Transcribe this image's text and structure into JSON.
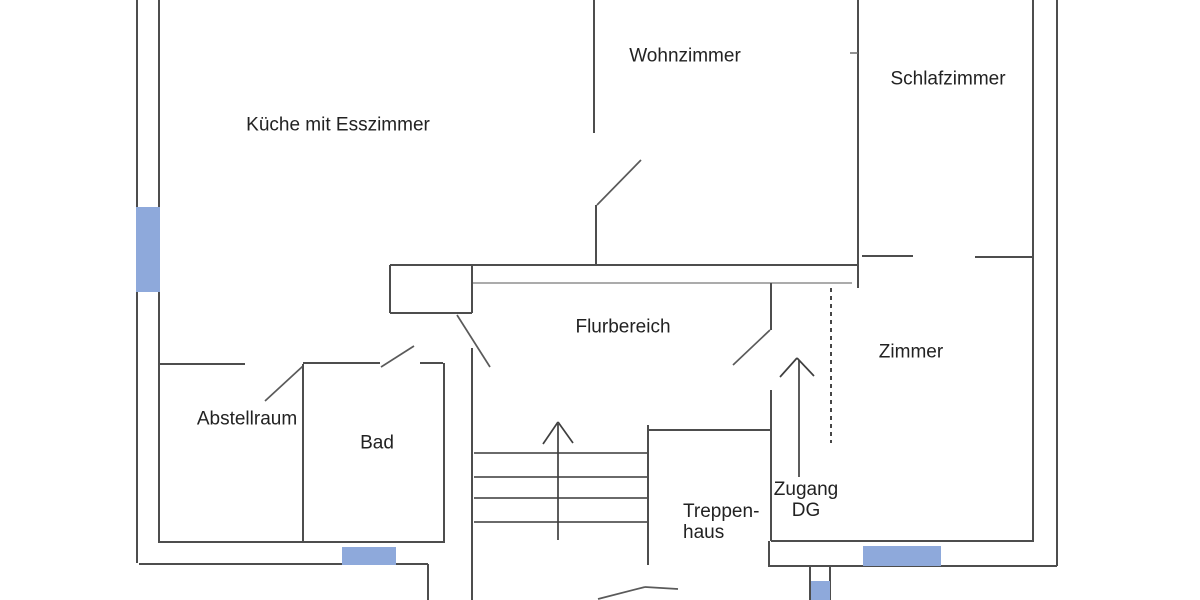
{
  "document": {
    "type": "floor-plan",
    "language": "German",
    "background_color": "#ffffff"
  },
  "style": {
    "text_color": "#222222",
    "window_color": "#8ea9db",
    "kinds": {
      "wall": {
        "color": "#4d4d4d",
        "width": 2
      },
      "thin": {
        "color": "#6e6e6e",
        "width": 1.5
      },
      "light": {
        "color": "#8f8f8f",
        "width": 1.6
      },
      "door": {
        "color": "#5a5a5a",
        "width": 1.7
      },
      "stair": {
        "color": "#555555",
        "width": 1.7
      },
      "arrow": {
        "color": "#3f3f3f",
        "width": 1.7
      },
      "dash": {
        "color": "#333333",
        "width": 1.8,
        "dash": "4 4"
      }
    }
  },
  "rooms": [
    {
      "id": "kueche",
      "label": "Küche mit Esszimmer",
      "x": 338,
      "y": 125,
      "align": "center"
    },
    {
      "id": "wohnzimmer",
      "label": "Wohnzimmer",
      "x": 685,
      "y": 56,
      "align": "center"
    },
    {
      "id": "schlafzimmer",
      "label": "Schlafzimmer",
      "x": 948,
      "y": 79,
      "align": "center"
    },
    {
      "id": "flurbereich",
      "label": "Flurbereich",
      "x": 623,
      "y": 327,
      "align": "center"
    },
    {
      "id": "abstellraum",
      "label": "Abstellraum",
      "x": 247,
      "y": 419,
      "align": "center"
    },
    {
      "id": "bad",
      "label": "Bad",
      "x": 377,
      "y": 443,
      "align": "center"
    },
    {
      "id": "zimmer",
      "label": "Zimmer",
      "x": 911,
      "y": 352,
      "align": "center"
    },
    {
      "id": "treppenhaus",
      "label": "Treppen-\nhaus",
      "x": 683,
      "y": 522,
      "align": "left"
    },
    {
      "id": "zugang-dg",
      "label": "Zugang\nDG",
      "x": 806,
      "y": 500,
      "align": "center"
    }
  ],
  "plan": {
    "lines": [
      {
        "name": "wall-exterior-left-outer",
        "k": "wall",
        "x1": 137,
        "y1": 0,
        "x2": 137,
        "y2": 563
      },
      {
        "name": "wall-exterior-left-inner",
        "k": "wall",
        "x1": 159,
        "y1": 0,
        "x2": 159,
        "y2": 542
      },
      {
        "name": "wall-bottom-left-inner",
        "k": "wall",
        "x1": 158,
        "y1": 542,
        "x2": 445,
        "y2": 542
      },
      {
        "name": "wall-bottom-left-outer",
        "k": "wall",
        "x1": 139,
        "y1": 564,
        "x2": 428,
        "y2": 564
      },
      {
        "name": "wall-stair-bay-left",
        "k": "wall",
        "x1": 428,
        "y1": 564,
        "x2": 428,
        "y2": 600
      },
      {
        "name": "wall-kueche-wohnzimmer-upper",
        "k": "wall",
        "x1": 594,
        "y1": 0,
        "x2": 594,
        "y2": 133
      },
      {
        "name": "wall-kueche-wohnzimmer-lower",
        "k": "wall",
        "x1": 596,
        "y1": 205,
        "x2": 596,
        "y2": 265
      },
      {
        "name": "door-swing-wohnzimmer",
        "k": "door",
        "x1": 597,
        "y1": 205,
        "x2": 641,
        "y2": 160
      },
      {
        "name": "wall-corridor-upper",
        "k": "wall",
        "x1": 390,
        "y1": 265,
        "x2": 858,
        "y2": 265
      },
      {
        "name": "wall-corridor-lower",
        "k": "light",
        "x1": 472,
        "y1": 283,
        "x2": 852,
        "y2": 283
      },
      {
        "name": "wall-pier-left",
        "k": "wall",
        "x1": 390,
        "y1": 265,
        "x2": 390,
        "y2": 313
      },
      {
        "name": "wall-pier-bottom",
        "k": "wall",
        "x1": 390,
        "y1": 313,
        "x2": 472,
        "y2": 313
      },
      {
        "name": "wall-pier-right",
        "k": "wall",
        "x1": 472,
        "y1": 265,
        "x2": 472,
        "y2": 313
      },
      {
        "name": "door-swing-kueche-flur",
        "k": "door",
        "x1": 457,
        "y1": 315,
        "x2": 490,
        "y2": 367
      },
      {
        "name": "wall-wohnzimmer-schlafzimmer",
        "k": "wall",
        "x1": 858,
        "y1": 0,
        "x2": 858,
        "y2": 288
      },
      {
        "name": "tick-schlafzimmer-door",
        "k": "thin",
        "x1": 850,
        "y1": 53,
        "x2": 858,
        "y2": 53
      },
      {
        "name": "wall-schlafzimmer-zimmer-left",
        "k": "wall",
        "x1": 862,
        "y1": 256,
        "x2": 913,
        "y2": 256
      },
      {
        "name": "wall-schlafzimmer-zimmer-right",
        "k": "wall",
        "x1": 975,
        "y1": 257,
        "x2": 1033,
        "y2": 257
      },
      {
        "name": "wall-exterior-right-inner",
        "k": "wall",
        "x1": 1033,
        "y1": 0,
        "x2": 1033,
        "y2": 542
      },
      {
        "name": "wall-exterior-right-outer",
        "k": "wall",
        "x1": 1057,
        "y1": 0,
        "x2": 1057,
        "y2": 566
      },
      {
        "name": "wall-bottom-right-inner",
        "k": "wall",
        "x1": 771,
        "y1": 541,
        "x2": 1033,
        "y2": 541
      },
      {
        "name": "wall-bottom-right-outer",
        "k": "wall",
        "x1": 768,
        "y1": 566,
        "x2": 1057,
        "y2": 566
      },
      {
        "name": "wall-abstellraum-top",
        "k": "wall",
        "x1": 159,
        "y1": 364,
        "x2": 245,
        "y2": 364
      },
      {
        "name": "door-swing-abstellraum",
        "k": "door",
        "x1": 265,
        "y1": 401,
        "x2": 303,
        "y2": 366
      },
      {
        "name": "wall-abstellraum-bad",
        "k": "wall",
        "x1": 303,
        "y1": 364,
        "x2": 303,
        "y2": 542
      },
      {
        "name": "wall-bad-top",
        "k": "wall",
        "x1": 303,
        "y1": 363,
        "x2": 380,
        "y2": 363
      },
      {
        "name": "door-swing-bad",
        "k": "door",
        "x1": 381,
        "y1": 367,
        "x2": 414,
        "y2": 346
      },
      {
        "name": "tick-bad-top-right",
        "k": "wall",
        "x1": 420,
        "y1": 363,
        "x2": 443,
        "y2": 363
      },
      {
        "name": "wall-bad-right",
        "k": "wall",
        "x1": 444,
        "y1": 363,
        "x2": 444,
        "y2": 542
      },
      {
        "name": "wall-stairwell-left",
        "k": "wall",
        "x1": 472,
        "y1": 348,
        "x2": 472,
        "y2": 600
      },
      {
        "name": "stair-tread-1",
        "k": "stair",
        "x1": 474,
        "y1": 453,
        "x2": 648,
        "y2": 453
      },
      {
        "name": "stair-tread-2",
        "k": "stair",
        "x1": 474,
        "y1": 477,
        "x2": 648,
        "y2": 477
      },
      {
        "name": "stair-tread-3",
        "k": "stair",
        "x1": 474,
        "y1": 498,
        "x2": 648,
        "y2": 498
      },
      {
        "name": "stair-tread-4",
        "k": "stair",
        "x1": 474,
        "y1": 522,
        "x2": 648,
        "y2": 522
      },
      {
        "name": "wall-stairwell-right",
        "k": "wall",
        "x1": 648,
        "y1": 425,
        "x2": 648,
        "y2": 565
      },
      {
        "name": "wall-treppenhaus-top",
        "k": "wall",
        "x1": 648,
        "y1": 430,
        "x2": 770,
        "y2": 430
      },
      {
        "name": "stairs-up-arrow-shaft",
        "k": "arrow",
        "x1": 558,
        "y1": 424,
        "x2": 558,
        "y2": 540
      },
      {
        "name": "stairs-up-arrow-head-left",
        "k": "arrow",
        "x1": 558,
        "y1": 422,
        "x2": 543,
        "y2": 444
      },
      {
        "name": "stairs-up-arrow-head-right",
        "k": "arrow",
        "x1": 558,
        "y1": 422,
        "x2": 573,
        "y2": 443
      },
      {
        "name": "wall-flur-jamb",
        "k": "wall",
        "x1": 771,
        "y1": 283,
        "x2": 771,
        "y2": 330
      },
      {
        "name": "door-swing-flur-treppenhaus",
        "k": "door",
        "x1": 770,
        "y1": 330,
        "x2": 733,
        "y2": 365
      },
      {
        "name": "wall-zugang-left",
        "k": "wall",
        "x1": 771,
        "y1": 390,
        "x2": 771,
        "y2": 541
      },
      {
        "name": "zugang-dg-arrow-shaft",
        "k": "arrow",
        "x1": 799,
        "y1": 360,
        "x2": 799,
        "y2": 477
      },
      {
        "name": "zugang-dg-arrow-head-left",
        "k": "arrow",
        "x1": 797,
        "y1": 358,
        "x2": 780,
        "y2": 377
      },
      {
        "name": "zugang-dg-arrow-head-right",
        "k": "arrow",
        "x1": 797,
        "y1": 358,
        "x2": 814,
        "y2": 376
      },
      {
        "name": "boundary-dashed-line",
        "k": "dash",
        "x1": 831,
        "y1": 288,
        "x2": 831,
        "y2": 443
      },
      {
        "name": "wall-step-connector",
        "k": "wall",
        "x1": 769,
        "y1": 541,
        "x2": 769,
        "y2": 566
      },
      {
        "name": "wall-chimney-left",
        "k": "wall",
        "x1": 810,
        "y1": 566,
        "x2": 810,
        "y2": 600
      },
      {
        "name": "wall-chimney-right",
        "k": "wall",
        "x1": 830,
        "y1": 566,
        "x2": 830,
        "y2": 600
      },
      {
        "name": "door-swing-entry-cutoff-a",
        "k": "door",
        "x1": 598,
        "y1": 599,
        "x2": 645,
        "y2": 587
      },
      {
        "name": "door-swing-entry-cutoff-b",
        "k": "door",
        "x1": 645,
        "y1": 587,
        "x2": 678,
        "y2": 589
      }
    ],
    "windows": [
      {
        "name": "window-marker-left",
        "x": 136,
        "y": 207,
        "w": 24,
        "h": 85
      },
      {
        "name": "window-marker-bottom-bad",
        "x": 342,
        "y": 547,
        "w": 54,
        "h": 18
      },
      {
        "name": "window-marker-bottom-zimmer",
        "x": 863,
        "y": 546,
        "w": 78,
        "h": 20
      },
      {
        "name": "window-marker-chimney",
        "x": 811,
        "y": 581,
        "w": 19,
        "h": 19
      }
    ]
  }
}
